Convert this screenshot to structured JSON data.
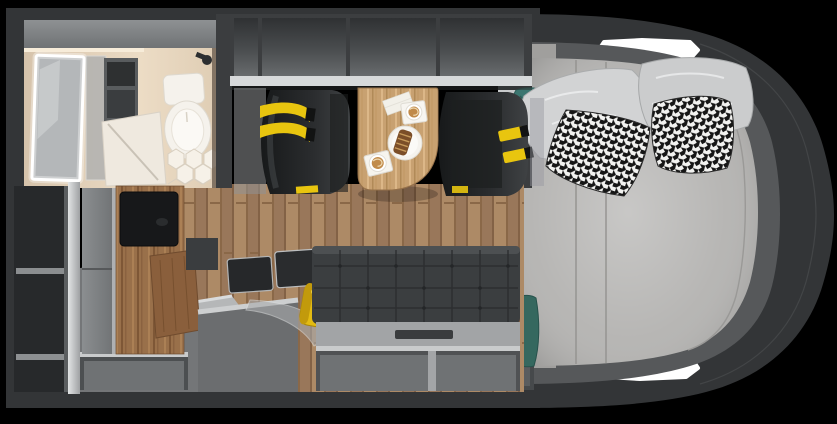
{
  "meta": {
    "description": "Top-down 3D rendered floor plan of a motorhome interior",
    "view": "overhead cutaway"
  },
  "colors": {
    "background": "#000000",
    "body_shell": "#333537",
    "inner_cap": "#56585a",
    "window_cutout": "#ffffff",
    "rail_white": "#d7d9da",
    "overhead_frame": "#3c3e40",
    "partition_dark": "#3b3d3f",
    "bathroom_floor": "#e3d3bd",
    "fixture_white": "#f5f2ec",
    "mirror_glass": "#b4b7b9",
    "wardrobe_interior": "#27292b",
    "shelf_edge": "#8b8e90",
    "fridge_gray": "#7d8082",
    "tv_black": "#17181a",
    "floor_wood": "#a27e5c",
    "table_wood": "#c8a171",
    "cabinet_wood": "#99704a",
    "counter_gray": "#747678",
    "appliance_dark": "#26282a",
    "metal_trim": "#c9cbcc",
    "display_blue": "#3a66ff",
    "kettle_yellow": "#e3bb12",
    "seat_dark": "#232526",
    "seatbelt_yellow": "#e8c50f",
    "sofa_dark": "#3b3e40",
    "sofa_seat_gray": "#a2a4a6",
    "storage_interior": "#6f7274",
    "mattress_gray": "#b3b2b0",
    "pillow_light": "#d2d3d4",
    "houndstooth_black": "#161616",
    "houndstooth_white": "#f2f2f0",
    "towel_teal": "#3c7670",
    "bed_platform": "#a09f9d"
  },
  "scene": {
    "areas": {
      "bathroom": {
        "position": "front-left",
        "fixtures": [
          "illuminated-mirror",
          "glass-shower",
          "cassette-toilet",
          "hexagon-tile-floor",
          "shower-head"
        ]
      },
      "wardrobe": {
        "position": "rear-left",
        "open_shelves": 3
      },
      "galley": {
        "position": "mid-left",
        "items": [
          "refrigerator",
          "tv-cabinet",
          "folding-table-leaf",
          "cooktop-cover",
          "sink-cover",
          "yellow-kettle",
          "blue-control-display"
        ]
      },
      "lounge": {
        "position": "center",
        "items": [
          "swivel-seat-left",
          "swivel-seat-right",
          "dining-table",
          "tufted-sofa"
        ],
        "seatbelt_straps": 2,
        "table_items": [
          "napkin",
          "cappuccino-cup",
          "pastry-plate",
          "cappuccino-cup"
        ]
      },
      "bedroom": {
        "position": "right-cap",
        "items": [
          "double-mattress",
          "headboard",
          "teal-towels"
        ],
        "pillows_light": 2,
        "pillows_houndstooth": 2,
        "towels": 2,
        "window_cutouts": 2
      },
      "storage": {
        "overhead_compartments": 4,
        "under_sofa_compartments": 2,
        "under_counter_compartments": 1
      }
    }
  }
}
